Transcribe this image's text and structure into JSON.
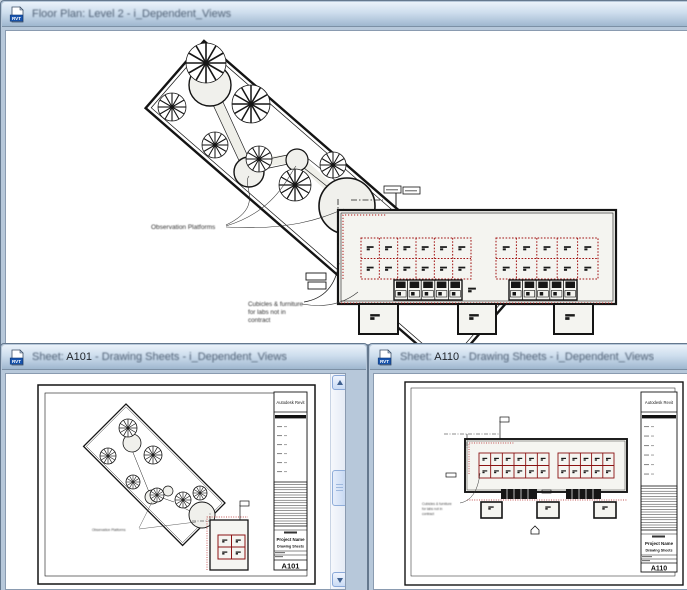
{
  "colors": {
    "cubicle_red": "#8b1212",
    "dotted_red": "#b01818",
    "titlebar_top": "#eaf2fa",
    "titlebar_bottom": "#9fb7cf",
    "scroll_arrow": "#3f608f"
  },
  "windows": {
    "floor_plan": {
      "icon": "RVT",
      "title": "Floor Plan: Level 2 - i_Dependent_Views"
    },
    "sheet_a101": {
      "icon": "RVT",
      "title_prefix": "Sheet: ",
      "sheet_number": "A101",
      "title_suffix": " - Drawing Sheets - i_Dependent_Views"
    },
    "sheet_a110": {
      "icon": "RVT",
      "title_prefix": "Sheet: ",
      "sheet_number": "A110",
      "title_suffix": " - Drawing Sheets - i_Dependent_Views"
    }
  },
  "floor_plan": {
    "labels": {
      "platforms": "Observation Platforms",
      "cubicles_1": "Cubicles & furniture",
      "cubicles_2": "for labs not in",
      "cubicles_3": "contract"
    },
    "cubicle_banks": {
      "left": {
        "cols": 6,
        "rows": 2
      },
      "right": {
        "cols": 5,
        "rows": 2
      }
    }
  },
  "sheet_a101": {
    "titleblock": {
      "brand": "Autodesk Revit",
      "project_name": "Project Name",
      "sheet_name": "Drawing Sheets",
      "sheet_number": "A101"
    },
    "labels": {
      "platforms": "Observation Platforms"
    },
    "cubicle_banks": {
      "corner": {
        "cols": 2,
        "rows": 2
      }
    }
  },
  "sheet_a110": {
    "titleblock": {
      "brand": "Autodesk Revit",
      "project_name": "Project Name",
      "sheet_name": "Drawing Sheets",
      "sheet_number": "A110"
    },
    "labels": {
      "cubicles_1": "Cubicles & furniture",
      "cubicles_2": "for labs not in",
      "cubicles_3": "contract"
    },
    "cubicle_banks": {
      "left": {
        "cols": 6,
        "rows": 2
      },
      "right": {
        "cols": 5,
        "rows": 2
      }
    }
  }
}
